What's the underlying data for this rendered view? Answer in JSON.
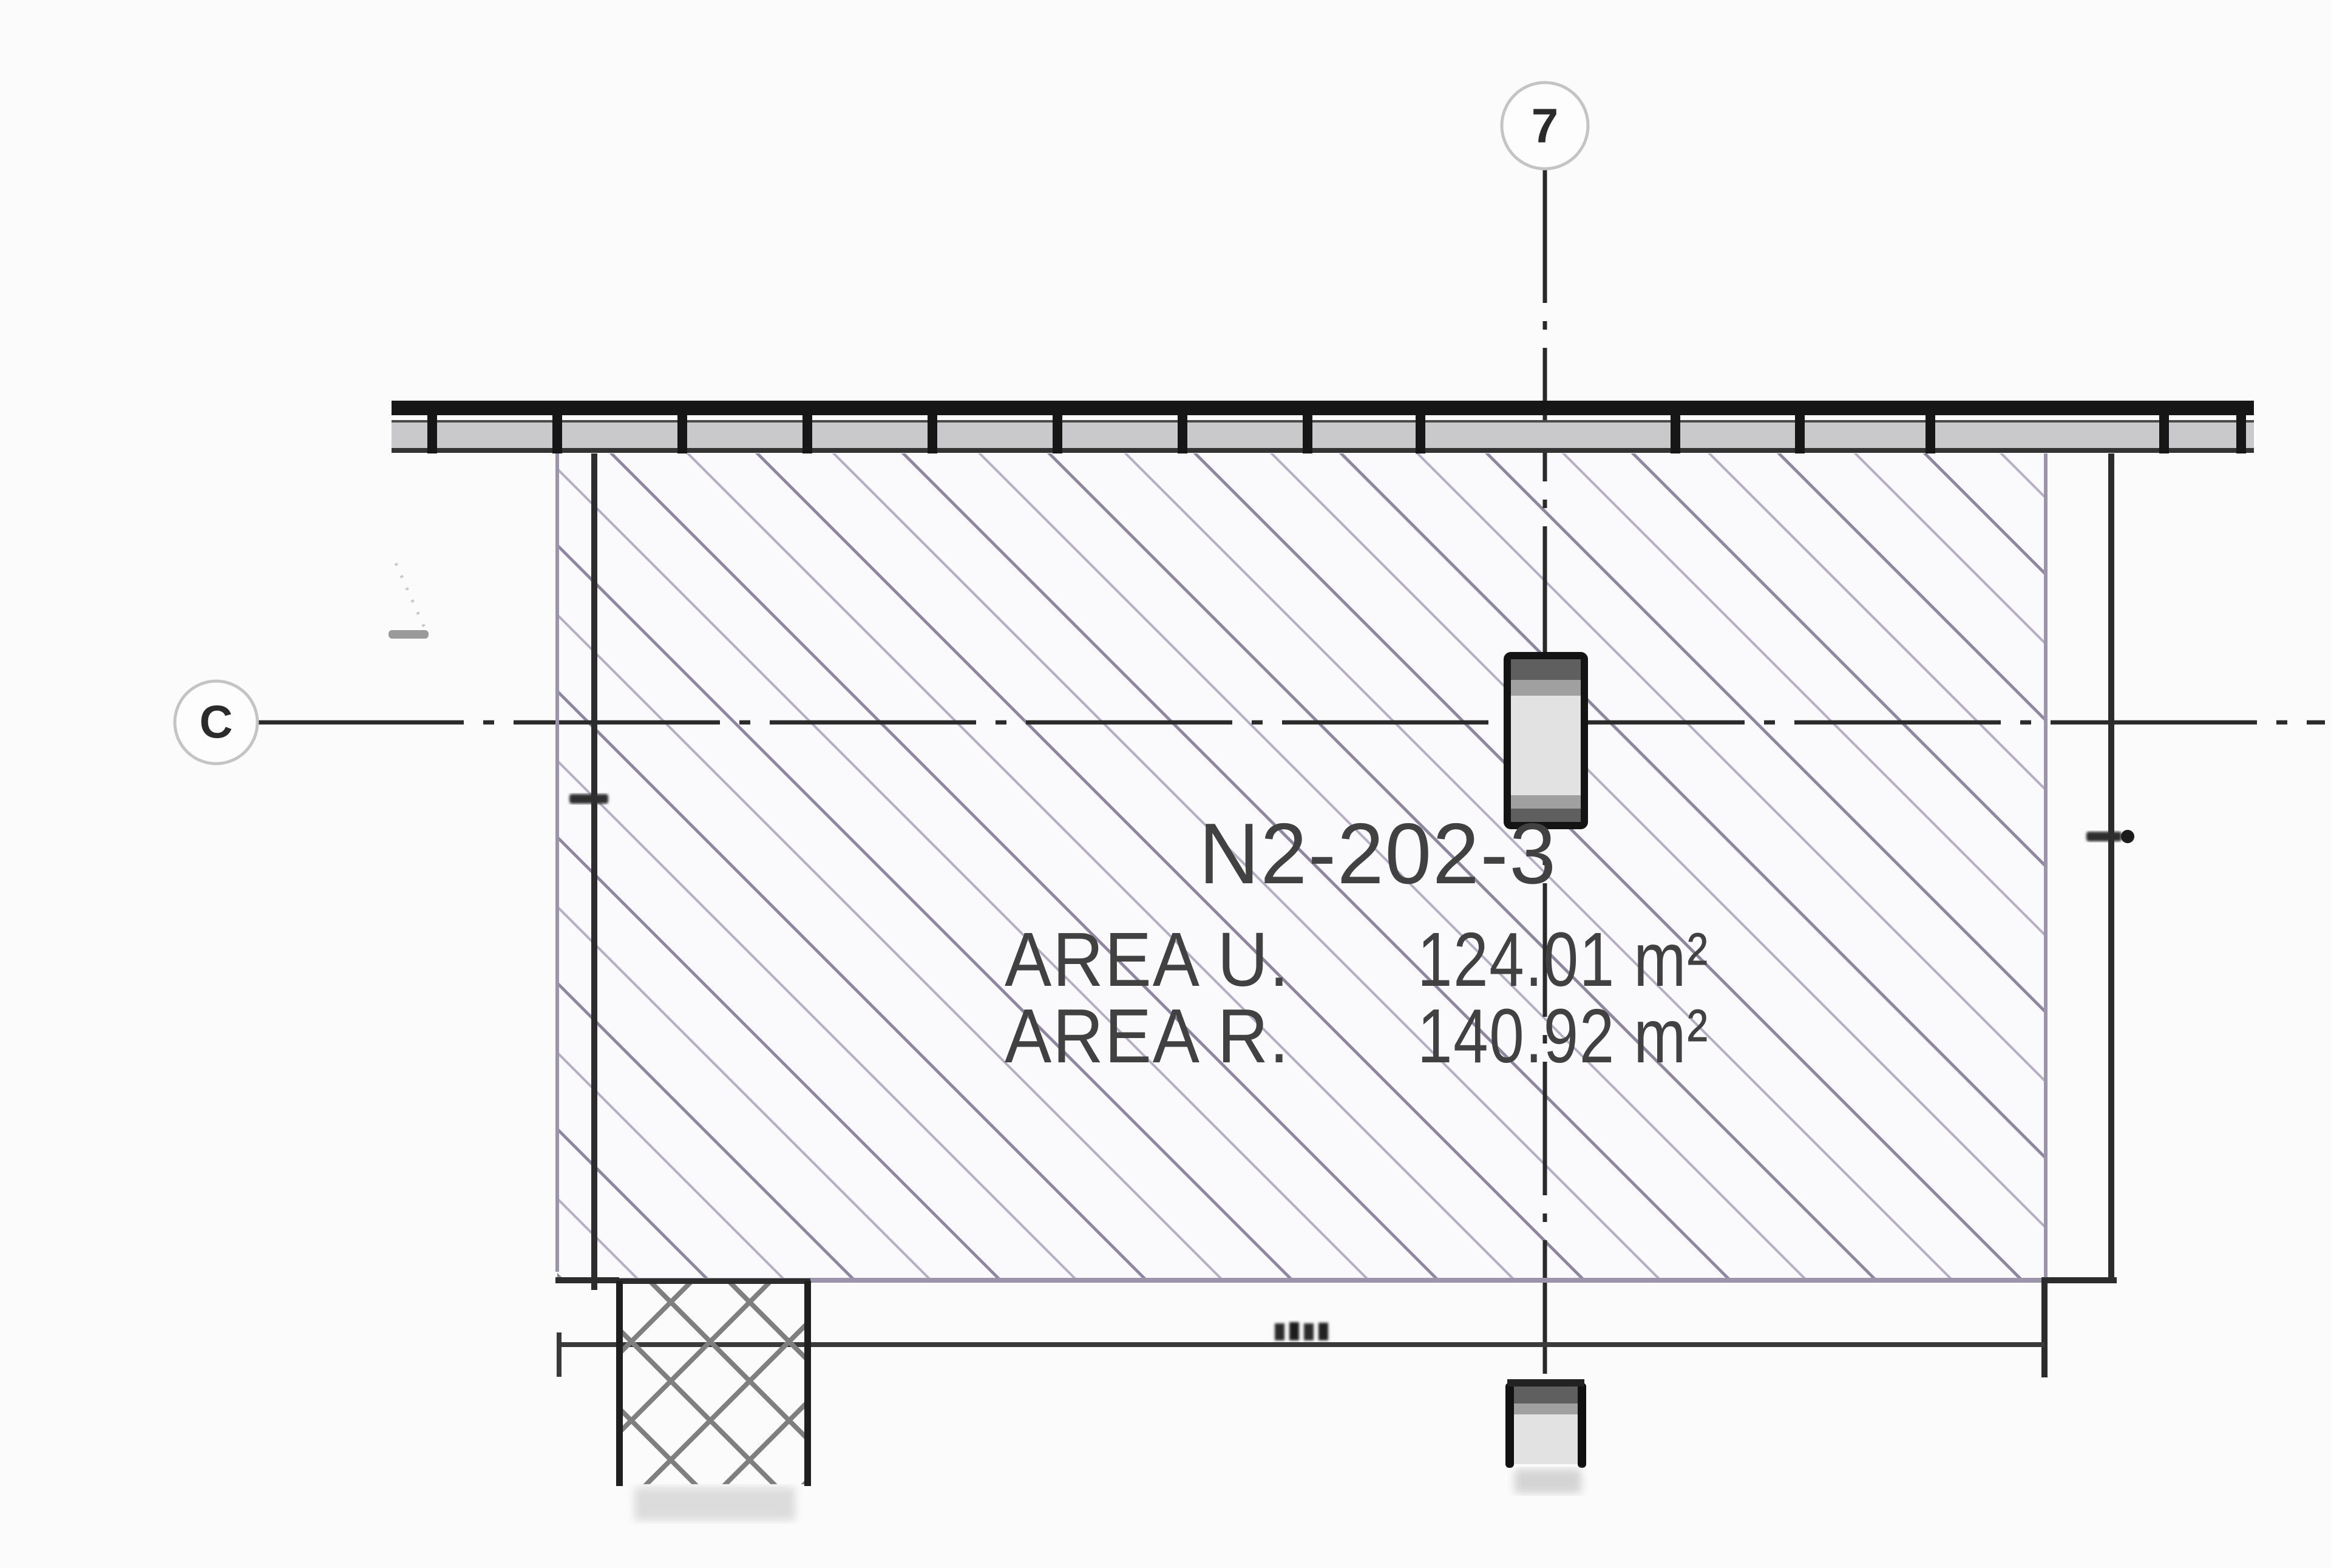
{
  "grid": {
    "column_marker": "7",
    "row_marker": "C"
  },
  "unit": {
    "code": "N2-202-3",
    "areas": [
      {
        "label": "AREA U.",
        "value": "124.01 m²"
      },
      {
        "label": "AREA R.",
        "value": "140.92 m²"
      }
    ]
  },
  "colors": {
    "hatch_dark": "#8f87a0",
    "hatch_light": "#b6aec3",
    "crosshatch": "#7f7f7f",
    "wall_fill": "#c9c9cc",
    "column_fill": "#e2e2e2",
    "column_cap_dark": "#5f5f5f",
    "column_cap_mid": "#a0a0a0",
    "line_dark": "#1f1f1f",
    "line_medium": "#3a3a3a",
    "hatch_edge": "#9c94ab",
    "circle_stroke": "#c4c4c4",
    "text": "#414141"
  }
}
